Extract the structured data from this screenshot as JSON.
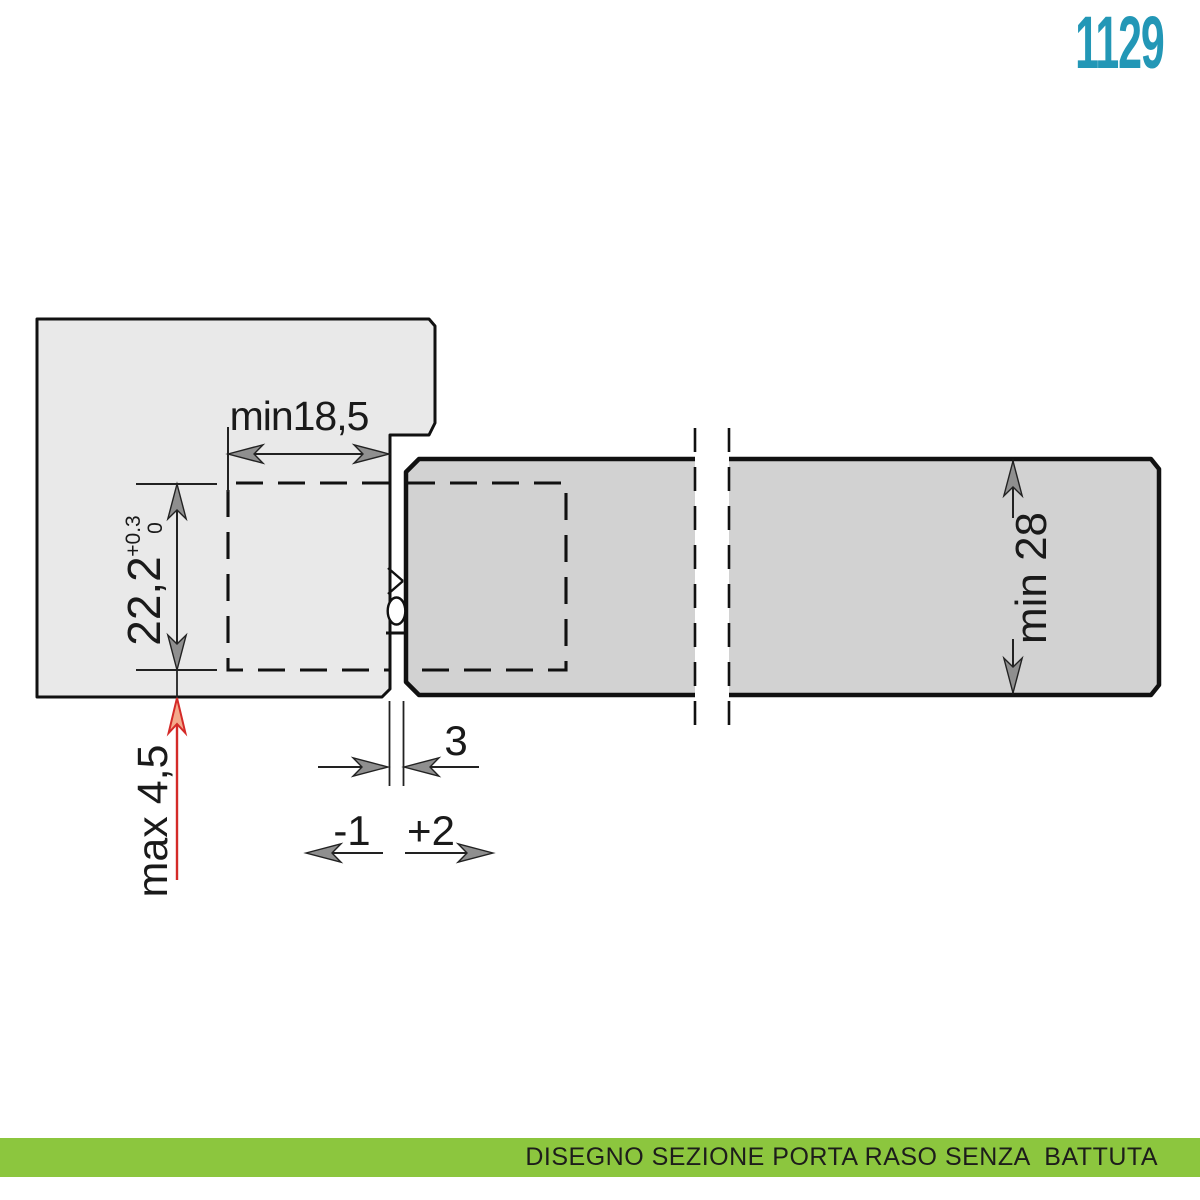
{
  "header": {
    "product_code": "1129"
  },
  "footer": {
    "caption": "DISEGNO SEZIONE PORTA RASO SENZA  BATTUTA"
  },
  "drawing": {
    "title_semantics": "door-frame-hinge-section",
    "dimensions": {
      "frame_depth": "min18,5",
      "cup_height": "22,2",
      "cup_tolerance_upper": "+0.3",
      "cup_tolerance_lower": "0",
      "bottom_clearance": "max 4,5",
      "gap_width": "3",
      "gap_adjust_minus": "-1",
      "gap_adjust_plus": "+2",
      "door_thickness": "min 28"
    },
    "colors": {
      "frame_fill": "#e9e9e9",
      "door_fill": "#d2d2d2",
      "outline": "#111111",
      "dimension_text": "#1a1a1a",
      "arrowhead_fill": "#8f8f8f",
      "alert_red": "#d42a28",
      "red_arrow_fill": "#f4a98b",
      "product_code_teal": "#2397b6",
      "banner_green": "#8cc63e"
    }
  }
}
